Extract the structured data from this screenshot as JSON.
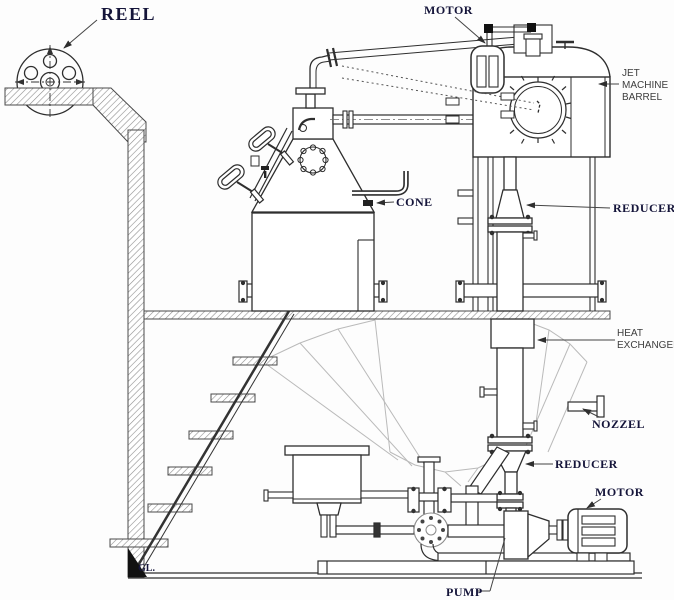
{
  "meta": {
    "description": "Engineering line diagram of a jet dyeing machine installation, side elevation",
    "width": 674,
    "height": 600,
    "background": "#fdfdfd"
  },
  "colors": {
    "line": "#2e2e2e",
    "light_line": "#bababa",
    "hatch": "#8f8f8f",
    "label_serif": "#15153a",
    "label_sans": "#3d3d3d"
  },
  "labels": {
    "reel": "REEL",
    "motor_top": "MOTOR",
    "jet_machine_barrel": {
      "line1": "JET",
      "line2": "MACHINE",
      "line3": "BARREL"
    },
    "cone": "CONE",
    "reducer_upper": "REDUCER",
    "heat_exchanger": {
      "line1": "HEAT",
      "line2": "EXCHANGER"
    },
    "nozzle": "NOZZEL",
    "reducer_lower": "REDUCER",
    "motor_lower": "MOTOR",
    "pump": "PUMP",
    "ground_level": "GL."
  }
}
